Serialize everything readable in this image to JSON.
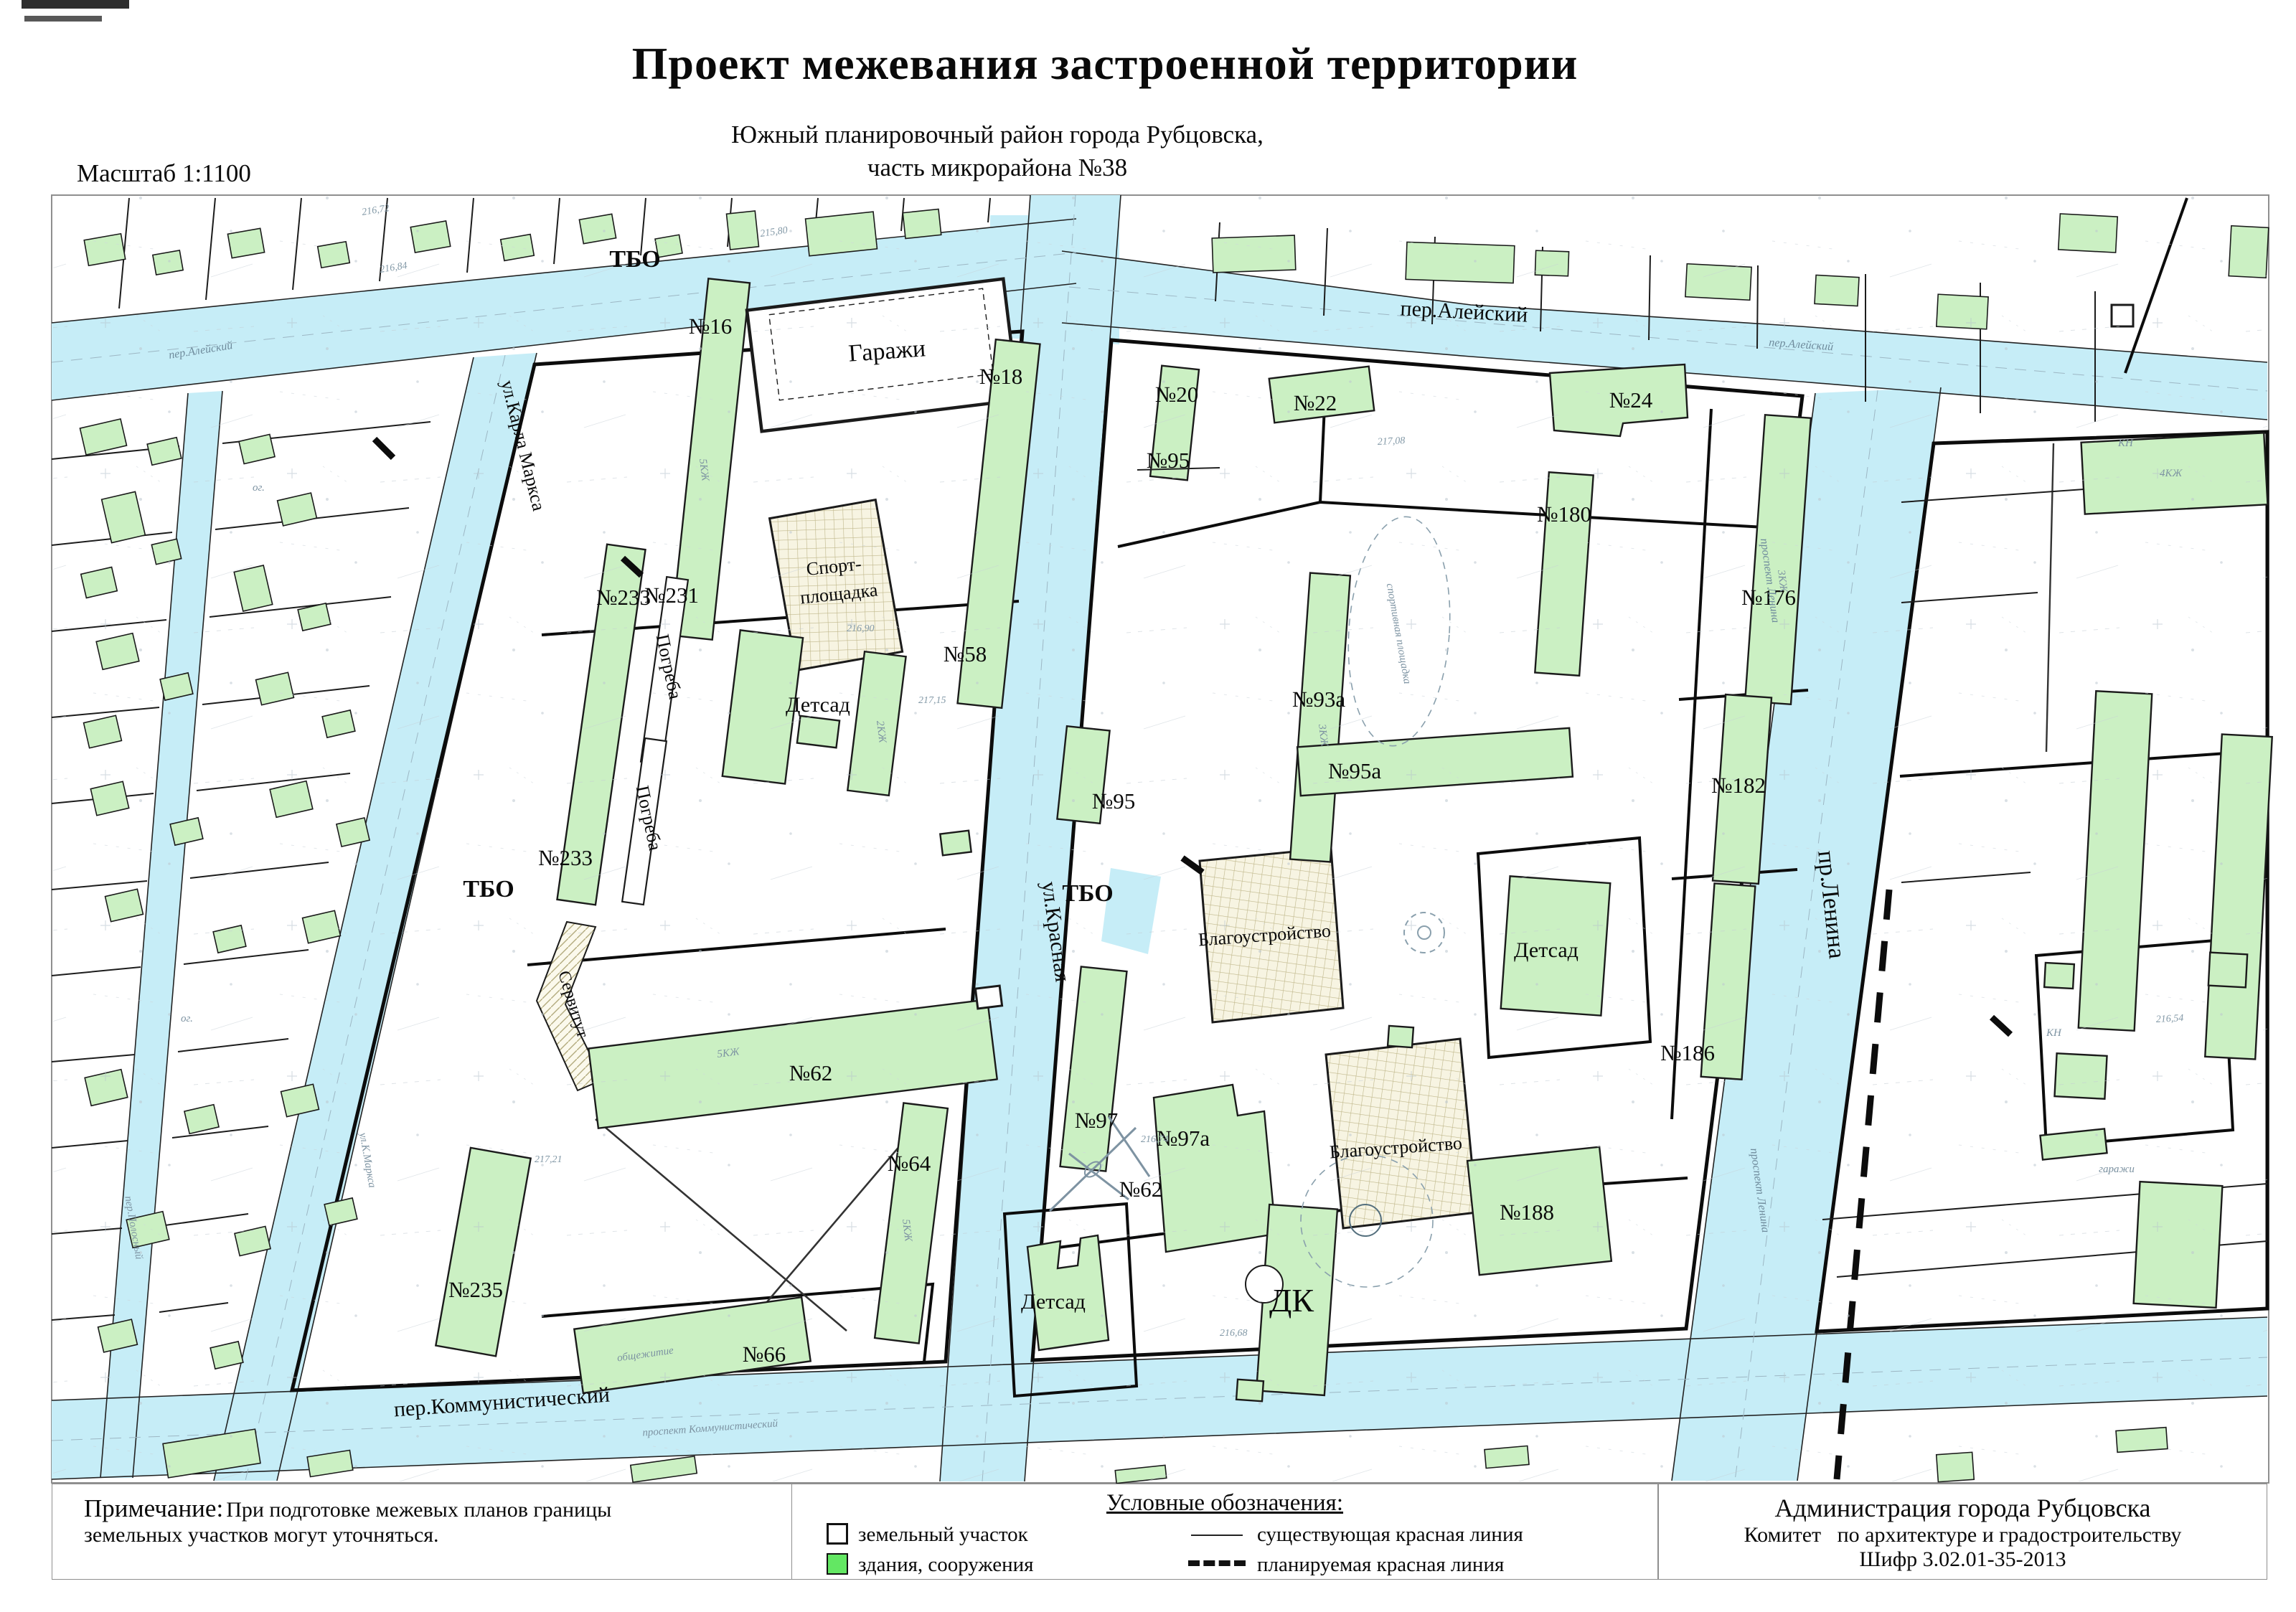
{
  "page": {
    "title": "Проект межевания застроенной территории",
    "subtitle1": "Южный планировочный район города Рубцовска,",
    "subtitle2": "часть микрорайона №38",
    "scale": "Масштаб 1:1100"
  },
  "panels": {
    "note": {
      "heading": "Примечание:",
      "text1": "При подготовке межевых планов границы",
      "text2": "земельных участков могут уточняться."
    },
    "legend": {
      "heading": "Условные обозначения:",
      "land_parcel": "земельный участок",
      "buildings": "здания, сооружения",
      "existing_red_line": "существующая красная линия",
      "planned_red_line": "планируемая красная линия"
    },
    "admin": {
      "org": "Администрация города Рубцовска",
      "committee": "Комитет   по архитектуре и градостроительству",
      "code": "Шифр 3.02.01-35-2013"
    }
  },
  "map": {
    "streets": {
      "aleysky": "пер.Алейский",
      "karl_marx": "ул.Карла Маркса",
      "krasnaya": "ул.Красная",
      "lenina": "пр.Ленина",
      "kommunistichesky": "пер.Коммунистический"
    },
    "areas": {
      "tbo": "ТБО",
      "garages": "Гаражи",
      "sport1": "Спорт-",
      "sport2": "площадка",
      "cellars": "Погреба",
      "servitude": "Сервитут",
      "kindergarten": "Детсад",
      "landscaping": "Благоустройство",
      "culture_house": "ДК"
    },
    "parcels": {
      "n16": "№16",
      "n18": "№18",
      "n58": "№58",
      "n231": "№231",
      "n233": "№233",
      "n235": "№235",
      "n62": "№62",
      "n64": "№64",
      "n66": "№66",
      "n20": "№20",
      "n22": "№22",
      "n24": "№24",
      "n95": "№95",
      "n95a": "№95а",
      "n93a": "№93а",
      "n97": "№97",
      "n97a": "№97а",
      "n180": "№180",
      "n176": "№176",
      "n182": "№182",
      "n186": "№186",
      "n188": "№188"
    },
    "handwritten": {
      "aleysky": "пер.Алейский",
      "lenina_avenue": "проспект Ленина",
      "kommunist_avenue": "проспект Коммунистический",
      "karl_marx": "ул.К.Маркса",
      "polosny": "пер.Полосный",
      "dormitory": "общежитие",
      "garages": "гаражи",
      "sport_ground": "спортивная площадка",
      "kzh5": "5КЖ",
      "kzh4": "4КЖ",
      "kzh3": "3КЖ",
      "kzh2": "2КЖ",
      "kn": "КН",
      "og": "ог."
    },
    "elevations": [
      "216,84",
      "215,80",
      "216,72",
      "217,15",
      "217,08",
      "216,90",
      "216,74",
      "216,68",
      "217,21",
      "216,54"
    ]
  },
  "colors": {
    "street": "#c6edf7",
    "building_fill": "#cbf0c3",
    "building_stroke": "#1b1b1b",
    "boundary": "#0c0c0c",
    "hatch_line": "#bfb78a",
    "topo_faint": "#9fb4c0"
  }
}
